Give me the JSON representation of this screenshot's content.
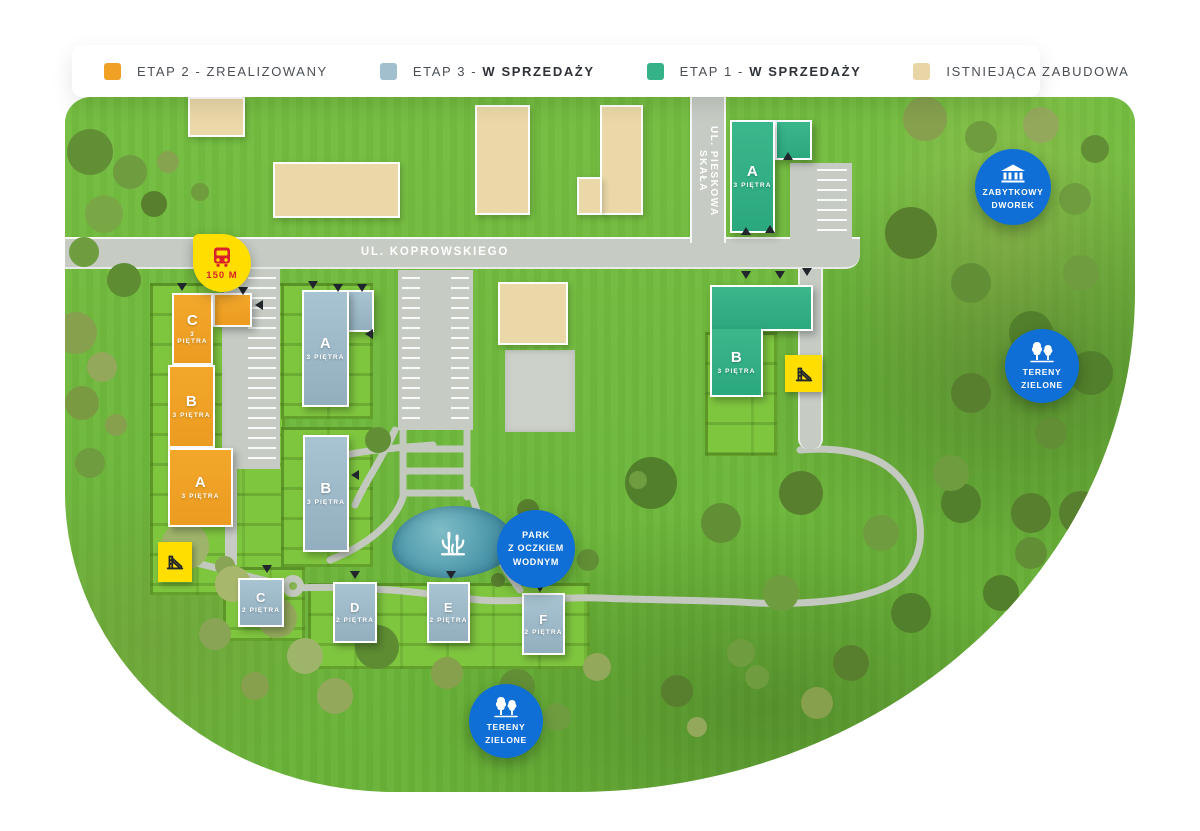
{
  "legend": {
    "items": [
      {
        "id": "etap2",
        "color": "#F0A125",
        "plain": "ETAP 2 - ZREALIZOWANY",
        "bold": ""
      },
      {
        "id": "etap3",
        "color": "#A2BFCE",
        "plain": "ETAP 3 - ",
        "bold": "W SPRZEDAŻY"
      },
      {
        "id": "etap1",
        "color": "#35B287",
        "plain": "ETAP 1 - ",
        "bold": "W SPRZEDAŻY"
      },
      {
        "id": "existing",
        "color": "#E9D6A6",
        "plain": "ISTNIEJĄCA ZABUDOWA",
        "bold": ""
      }
    ]
  },
  "roads": {
    "main": "UL. KOPROWSKIEGO",
    "side": "UL. PIESKOWA SKAŁA"
  },
  "buildings": {
    "orange": [
      {
        "name": "C",
        "floors": "3 PIĘTRA"
      },
      {
        "name": "B",
        "floors": "3 PIĘTRA"
      },
      {
        "name": "A",
        "floors": "3 PIĘTRA"
      }
    ],
    "blue_large": [
      {
        "name": "A",
        "floors": "3 PIĘTRA"
      },
      {
        "name": "B",
        "floors": "3 PIĘTRA"
      }
    ],
    "blue_small": [
      {
        "name": "C",
        "floors": "2 PIĘTRA"
      },
      {
        "name": "D",
        "floors": "2 PIĘTRA"
      },
      {
        "name": "E",
        "floors": "2 PIĘTRA"
      },
      {
        "name": "F",
        "floors": "2 PIĘTRA"
      }
    ],
    "green": [
      {
        "name": "A",
        "floors": "3 PIĘTRA"
      },
      {
        "name": "B",
        "floors": "3 PIĘTRA"
      }
    ]
  },
  "poi": {
    "bus": {
      "icon": "bus-icon",
      "distance": "150 M"
    },
    "badges": [
      {
        "id": "manor",
        "icon": "manor-icon",
        "lines": [
          "ZABYTKOWY",
          "DWOREK"
        ]
      },
      {
        "id": "green-areas-east",
        "icon": "trees-icon",
        "lines": [
          "TERENY",
          "ZIELONE"
        ]
      },
      {
        "id": "park",
        "icon": "",
        "lines": [
          "PARK",
          "Z OCZKIEM",
          "WODNYM"
        ]
      },
      {
        "id": "green-areas-south",
        "icon": "trees-icon",
        "lines": [
          "TERENY",
          "ZIELONE"
        ]
      }
    ]
  },
  "colors": {
    "etap2": "#F0A125",
    "etap3": "#A2BFCE",
    "etap1": "#35B287",
    "existing": "#E9D6A6",
    "badge_blue": "#0F6FD6",
    "bus_yellow": "#FFDE00",
    "bus_red": "#D8232A",
    "road_gray": "#C6CBC4",
    "grass": "#6FB93C",
    "pond": "#4F9AAD"
  }
}
